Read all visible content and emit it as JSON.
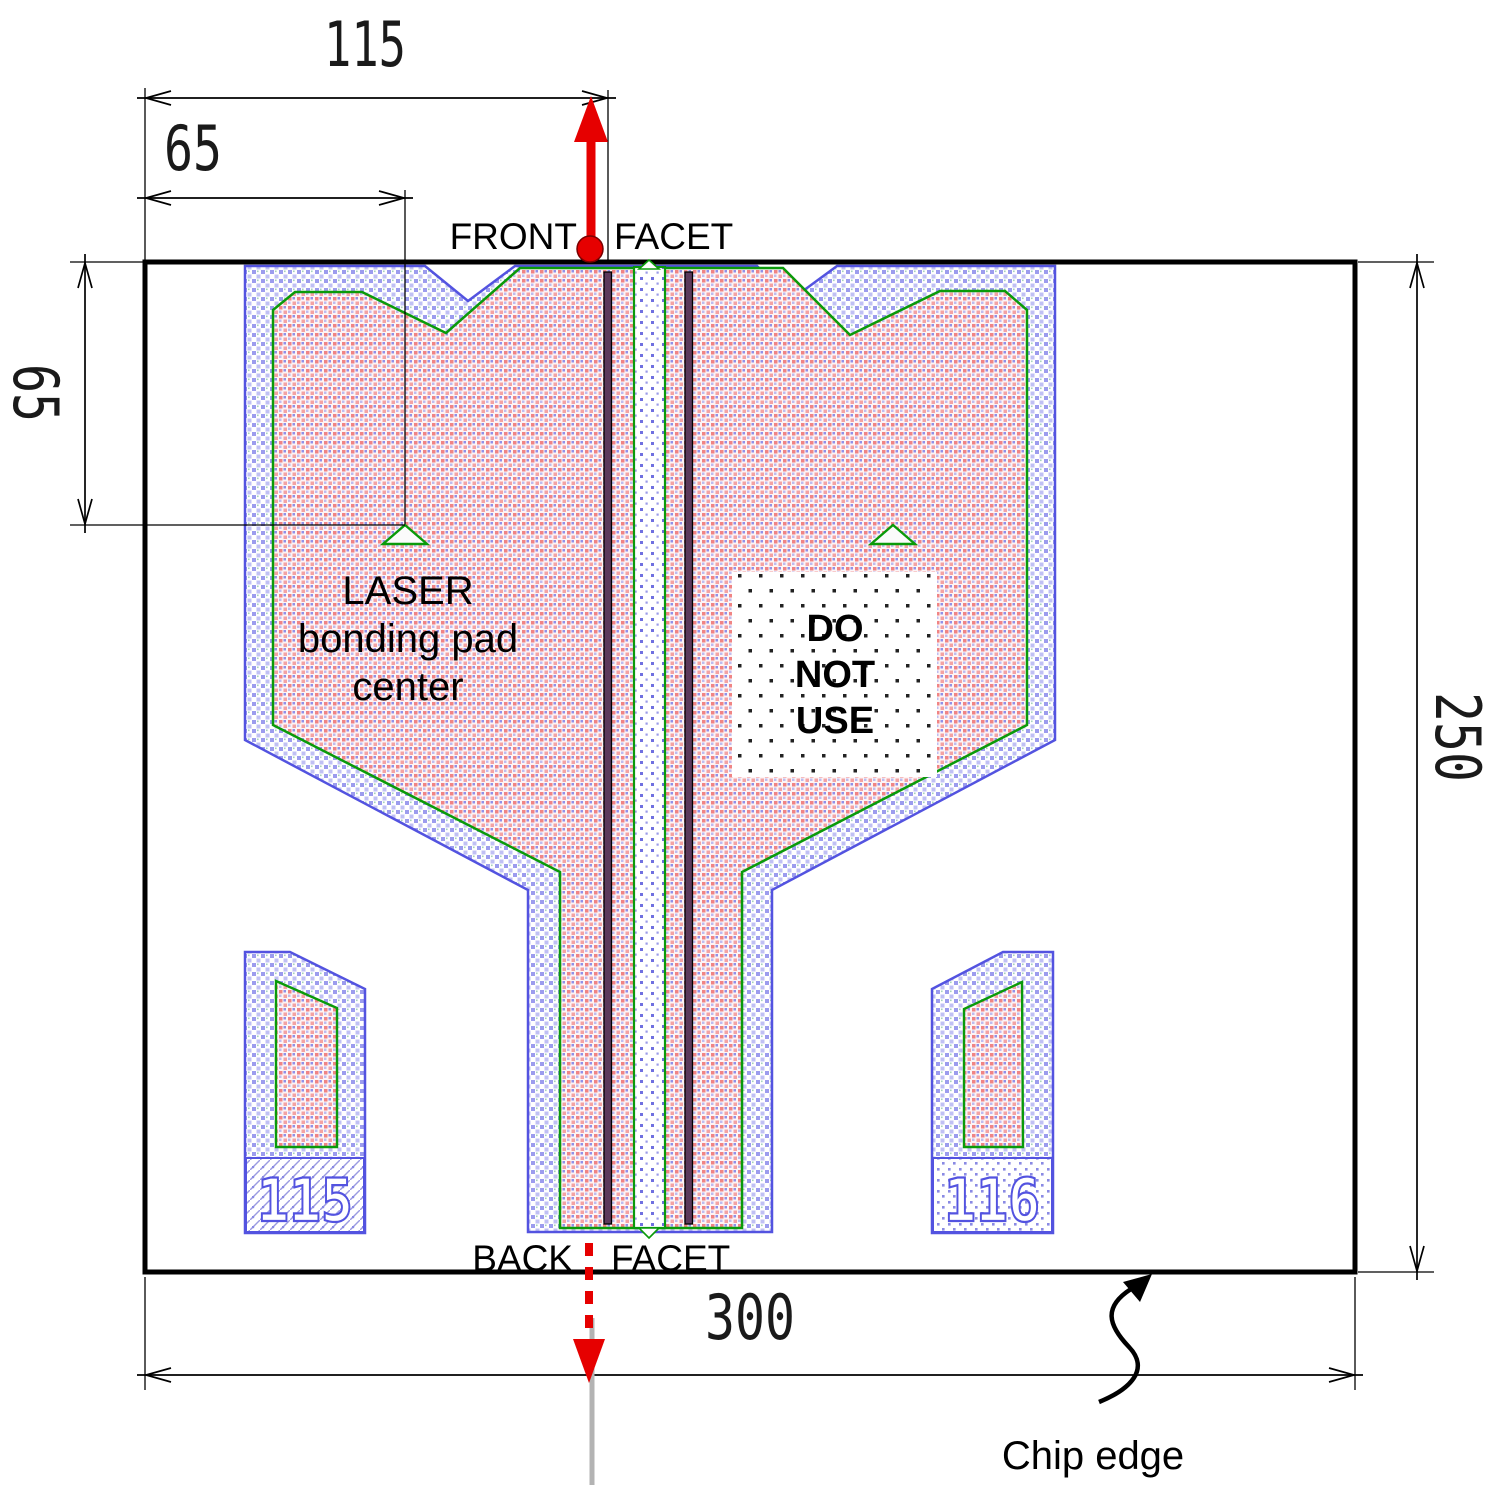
{
  "drawing": {
    "dims": {
      "top_width": "115",
      "pad_offset_x": "65",
      "pad_offset_y": "65",
      "chip_width": "300",
      "chip_height": "250"
    },
    "front_facet": {
      "left": "FRONT",
      "right": "FACET"
    },
    "back_facet": {
      "left": "BACK",
      "right": "FACET"
    },
    "laser_pad_label": [
      "LASER",
      "bonding pad",
      "center"
    ],
    "do_not_use": [
      "DO",
      "NOT",
      "USE"
    ],
    "chip_edge_label": "Chip edge",
    "pad_ids": {
      "left": "115",
      "right": "116"
    },
    "colors": {
      "metal_outline": "#5353e0",
      "inner_outline": "#0a9a0a",
      "facet_marker": "#e60000",
      "ridge_fill": "#5c3a5c",
      "cleave_line": "#b3b3b3",
      "dimension_line": "#000000"
    }
  }
}
